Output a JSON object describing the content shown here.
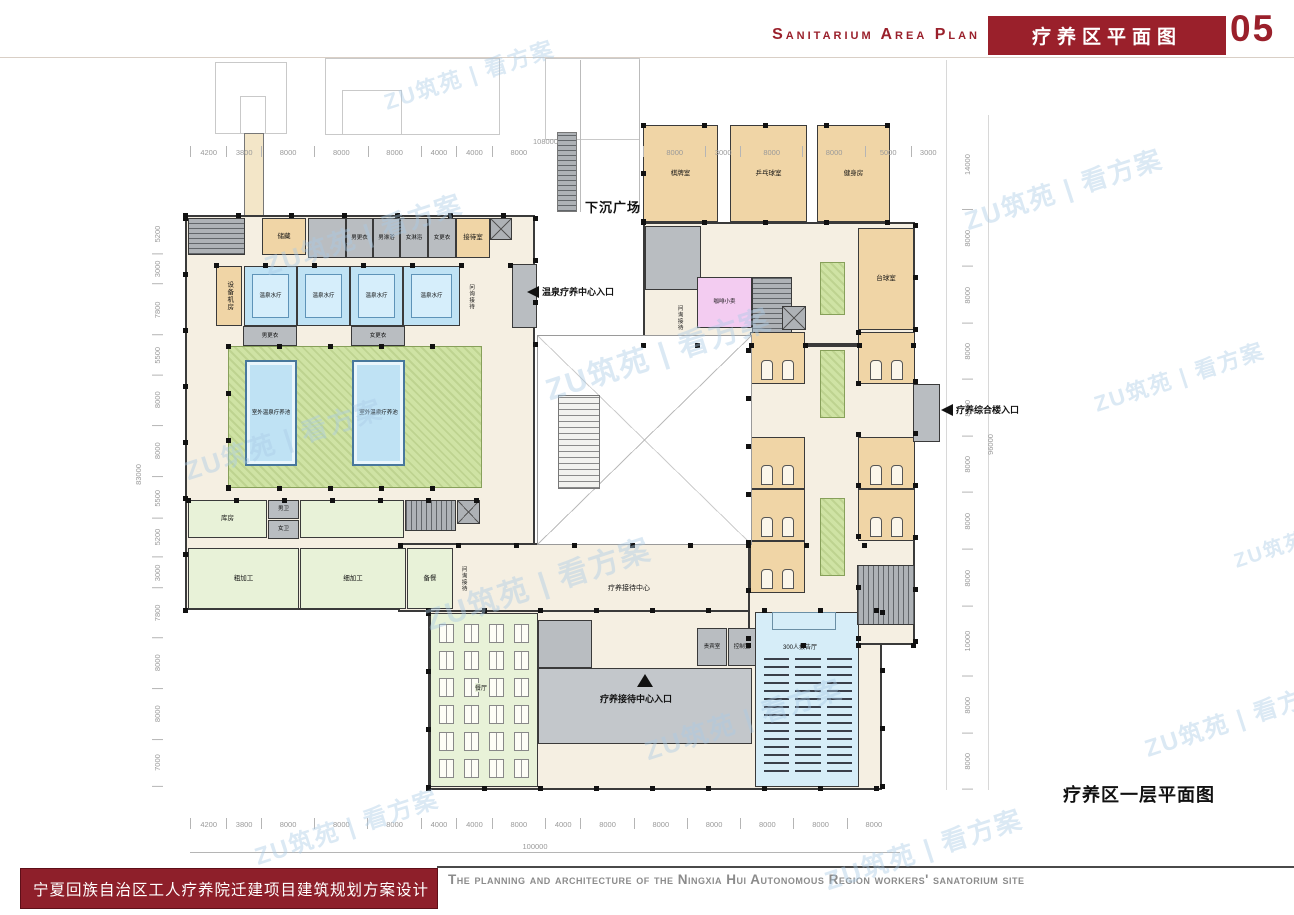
{
  "palette": {
    "accent": "#9a202b",
    "wall": "#3a3a3a",
    "floor": "#f5efe2",
    "room_tan": "#f0d5a6",
    "room_gray": "#b9bdc1",
    "room_green": "#e8f2d8",
    "courtyard": "#cfe3a4",
    "pool": "#bfe2f4",
    "room_pink": "#f3ccf1",
    "hall_blue": "#d6edf8",
    "plaza": "#c3c7cb",
    "dim": "#9a9a9a"
  },
  "header": {
    "title_en": "Sanitarium Area Plan",
    "title_zh": "疗养区平面图",
    "page_no": "05"
  },
  "footer": {
    "title_zh": "宁夏回族自治区工人疗养院迁建项目建筑规划方案设计",
    "caption_en": "The planning and architecture of the Ningxia Hui Autonomous Region workers' sanatorium site"
  },
  "watermark": {
    "text": "ZU筑苑 | 看方案"
  },
  "plan": {
    "caption": "疗养区一层平面图",
    "labels": {
      "sunken_plaza": "下沉广场",
      "reception_center": "疗养接待中心"
    },
    "entrances": {
      "spa": "温泉疗养中心入口",
      "complex": "疗养综合楼入口",
      "reception": "疗养接待中心入口"
    },
    "rooms": {
      "storage": "储藏",
      "men_changing": "男更衣",
      "men_shower": "男淋浴",
      "women_shower": "女淋浴",
      "women_changing": "女更衣",
      "reception_room": "接待室",
      "equipment_room": "设备机房",
      "spa_room": "温泉水疗",
      "inquiry": "问询接待",
      "outdoor_pool": "室外温泉疗养池",
      "storeroom": "库房",
      "men_wc": "男卫",
      "women_wc": "女卫",
      "rough_prep": "粗加工",
      "fine_prep": "细加工",
      "meal_prep": "备餐",
      "dining_hall": "餐厅",
      "vip_room": "贵宾室",
      "control_room": "控制室",
      "lecture_hall": "300人报告厅",
      "chess_room": "棋牌室",
      "table_tennis": "乒乓球室",
      "gym": "健身房",
      "coffee_shop": "咖啡小卖",
      "billiards": "台球室"
    },
    "dimensions": {
      "top_left": [
        "4200",
        "3800",
        "8000",
        "8000",
        "8000",
        "4000",
        "4000",
        "8000"
      ],
      "top_right": [
        "8000",
        "3000",
        "8000",
        "8000",
        "5000",
        "3000"
      ],
      "top_overall": "108000",
      "bottom": [
        "4200",
        "3800",
        "8000",
        "8000",
        "8000",
        "4000",
        "4000",
        "8000",
        "4000",
        "8000",
        "8000",
        "8000",
        "8000",
        "8000",
        "8000"
      ],
      "bottom_overall": "100000",
      "left": [
        "5200",
        "3000",
        "7800",
        "5500",
        "8000",
        "8000",
        "5500",
        "5200",
        "3000",
        "7800",
        "8000",
        "8000",
        "7000"
      ],
      "left_overall": "83000",
      "right": [
        "14000",
        "8000",
        "8000",
        "8000",
        "8000",
        "8000",
        "8000",
        "8000",
        "10000",
        "8000",
        "8000"
      ],
      "right_overall": "96000"
    }
  }
}
